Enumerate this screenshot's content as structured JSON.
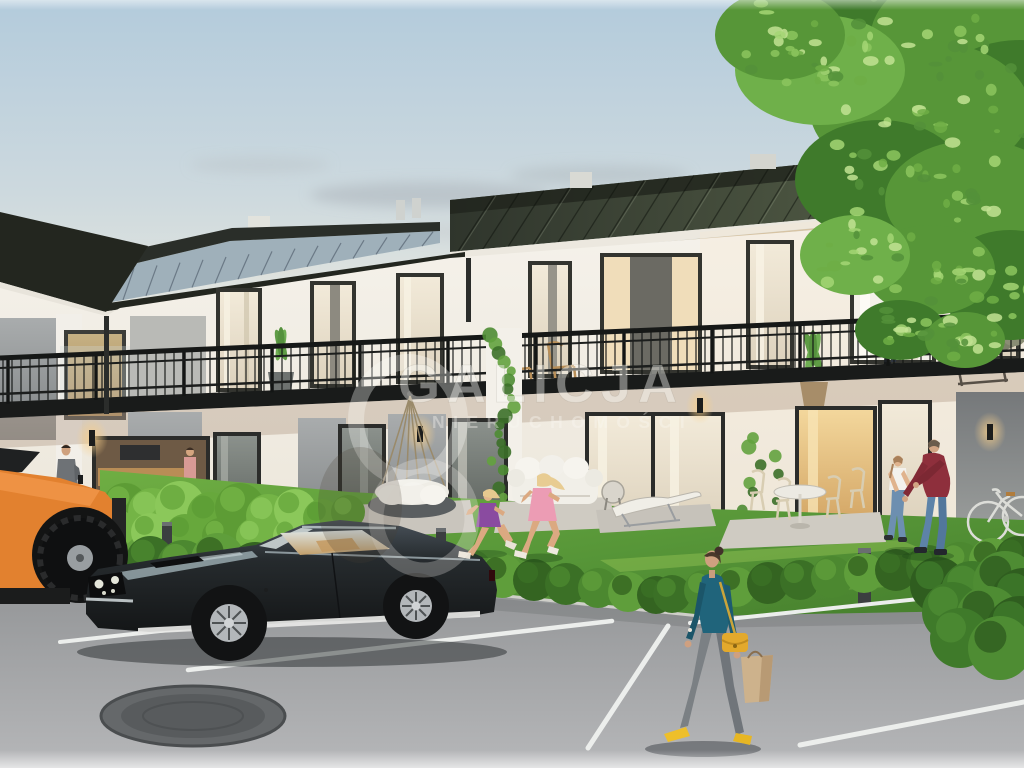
{
  "watermark": {
    "brand": "GALICJA",
    "subtitle": "NIERUCHOMOŚCI"
  },
  "colors": {
    "sky_top": "#b3cbdc",
    "sky_horizon": "#f2e9d7",
    "roof_dark": "#353b31",
    "roof_light_plane": "#9fb0ba",
    "fascia_white": "#ece8df",
    "facade_white": "#f2efe8",
    "panel_gray": "#8d9192",
    "railing_black": "#171917",
    "glass_reflect": "#7d837e",
    "warm_window": "#e9c285",
    "grass_green": "#5d9c3a",
    "hedge_green": "#3f7a2c",
    "asphalt_gray": "#a3a5a7",
    "marking_white": "#eceeec",
    "car_body_dark": "#23272a",
    "car_stripe": "#e8e8e6",
    "truck_orange": "#e2812f",
    "blouse_teal": "#20647b",
    "bag_yellow": "#e3a92c",
    "shirt_red": "#8e2f3c",
    "dress_purple": "#8a4ba0",
    "dress_pink": "#ec9cb4",
    "tree_green": "#579638",
    "watermark_white": "#fbfaf6"
  },
  "entities": [
    "terraced-apartment-building",
    "standing-seam-roof",
    "balcony-railing",
    "hanging-swing-sofa",
    "outdoor-sofa",
    "sun-lounger",
    "patio-dining-set",
    "classic-fastback-car",
    "orange-pickup-truck",
    "walking-woman-with-bags",
    "father-playing-with-child",
    "woman-on-balcony",
    "running-children",
    "bicycle",
    "oak-tree",
    "parking-lot",
    "manhole-cover",
    "hedges",
    "lawn"
  ]
}
